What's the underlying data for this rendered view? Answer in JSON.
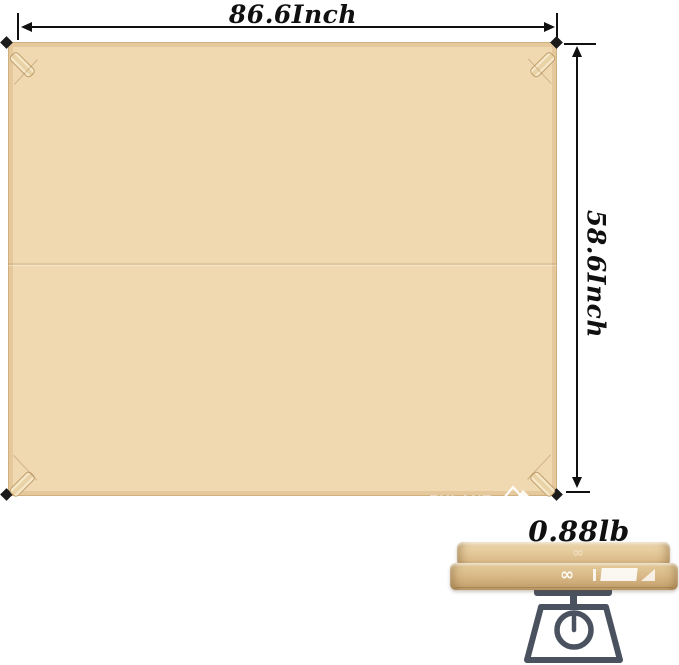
{
  "annotations": {
    "width_label": "86.6Inch",
    "height_label": "58.6Inch",
    "weight_label": "0.88lb"
  },
  "tarp": {
    "brand": "EULANT",
    "brand_sub": "Outdoors",
    "tagline": "Easy & Healthy & Comfort"
  },
  "folded_tarp": {
    "logo_mark": "∞"
  },
  "colors": {
    "annotation_text": "#101010",
    "tarp_fill": "#f0d8b0",
    "tarp_hem": "#dfc093",
    "stake": "#1b1b1b",
    "scale_icon": "#4a5260",
    "logo_text": "#ffffff",
    "background": "#ffffff"
  }
}
